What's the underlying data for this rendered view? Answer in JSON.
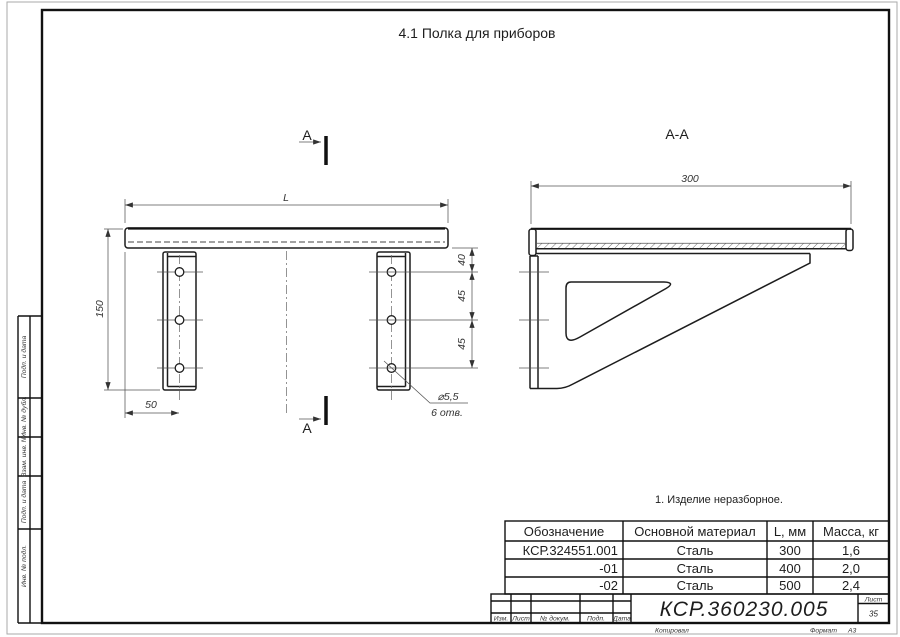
{
  "page": {
    "title": "4.1 Полка для приборов"
  },
  "front_view": {
    "section_label": "А",
    "dims": {
      "length": "L",
      "height": "150",
      "offset": "50",
      "chain": [
        "40",
        "45",
        "45"
      ],
      "hole_dia": "⌀5,5",
      "hole_count": "6 отв."
    }
  },
  "section_view": {
    "title": "А-А",
    "dims": {
      "depth": "300"
    }
  },
  "note": {
    "text": "1. Изделие неразборное."
  },
  "table": {
    "headers": [
      "Обозначение",
      "Основной материал",
      "L, мм",
      "Масса, кг"
    ],
    "rows": [
      [
        "КСР.324551.001",
        "Сталь",
        "300",
        "1,6"
      ],
      [
        "-01",
        "Сталь",
        "400",
        "2,0"
      ],
      [
        "-02",
        "Сталь",
        "500",
        "2,4"
      ]
    ]
  },
  "title_block": {
    "designation": "КСР.360230.005",
    "columns": [
      "Изм.",
      "Лист",
      "№ докум.",
      "Подп.",
      "Дата"
    ],
    "sheet_label": "Лист",
    "sheet_number": "35",
    "footer_copy": "Копировал",
    "footer_format_label": "Формат",
    "footer_format_value": "А3"
  },
  "side_margin": {
    "blocks": [
      "Подп. и дата",
      "Инв. № дубл.",
      "Взам. инв. №",
      "Подп. и дата",
      "Инв. № подл."
    ]
  }
}
